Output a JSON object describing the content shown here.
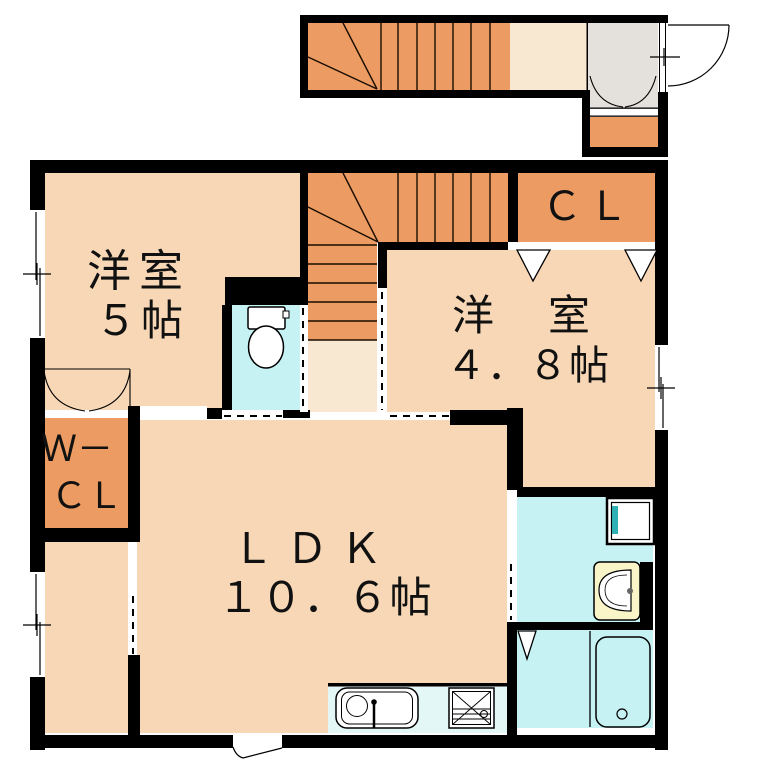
{
  "floorplan": {
    "rooms": {
      "room1_name": "洋室",
      "room1_size": "５帖",
      "closet1_label": "ＣＬ",
      "room2_name": "洋　室",
      "room2_size": "４．８帖",
      "wcl_line1": "Ｗ－",
      "wcl_line2": "ＣＬ",
      "ldk_name": "ＬＤＫ",
      "ldk_size": "１０．６帖"
    },
    "colors": {
      "wall": "#000000",
      "room_fill": "#f7d7b5",
      "landing_fill": "#f8e7d1",
      "stairs_fill": "#ec9c62",
      "wet_area_fill": "#c6f2f4",
      "kitchen_fill": "#e3f7f7",
      "entry_fill": "#e4e1dc",
      "basin_fill": "#f9f5c8",
      "washer_accent": "#2fb0b5"
    }
  }
}
